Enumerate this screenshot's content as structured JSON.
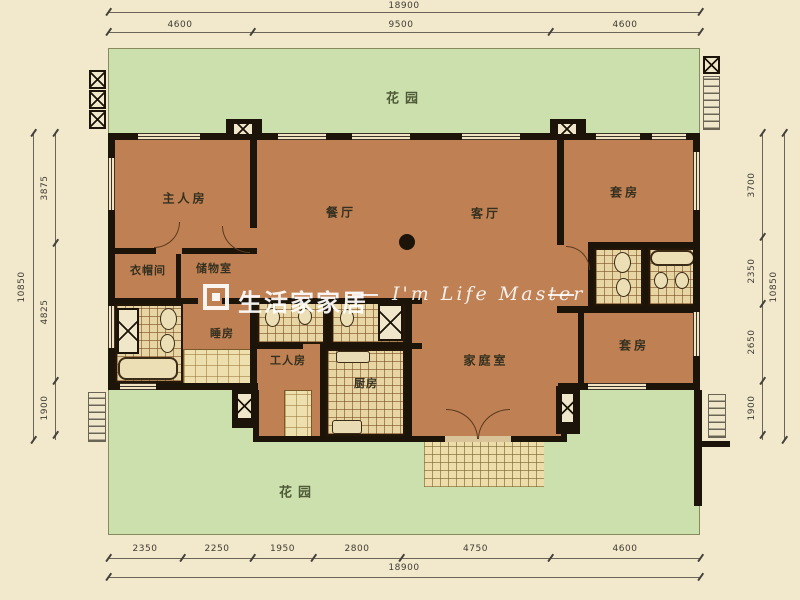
{
  "title": "户型图 floor plan",
  "dimensions": {
    "top": {
      "total": "18900",
      "segments": [
        "4600",
        "9500",
        "4600"
      ]
    },
    "bottom": {
      "total": "18900",
      "segments": [
        "2350",
        "2250",
        "1950",
        "2800",
        "4750",
        "4600"
      ]
    },
    "left": {
      "total": "10850",
      "segments": [
        "3875",
        "4825",
        "1900"
      ]
    },
    "right": {
      "total": "10850",
      "segments": [
        "3700",
        "2350",
        "2650",
        "1900"
      ]
    }
  },
  "rooms": {
    "garden_top": "花园",
    "master": "主人房",
    "dining": "餐厅",
    "living": "客厅",
    "suite_top": "套房",
    "cloakroom": "衣帽间",
    "storage": "储物室",
    "bedroom": "睡房",
    "maid": "工人房",
    "kitchen": "厨房",
    "family": "家庭室",
    "suite_bottom": "套房",
    "garden_bottom": "花园"
  },
  "watermark": {
    "brand": "生活家家居",
    "slogan": "I'm Life Master",
    "dash": ""
  },
  "colors": {
    "background": "#f2e9cc",
    "garden": "#cbe0ad",
    "floor": "#bf8054",
    "wall": "#1c1409",
    "tile": "#e8d5a4",
    "watermark": "#ffffff"
  }
}
